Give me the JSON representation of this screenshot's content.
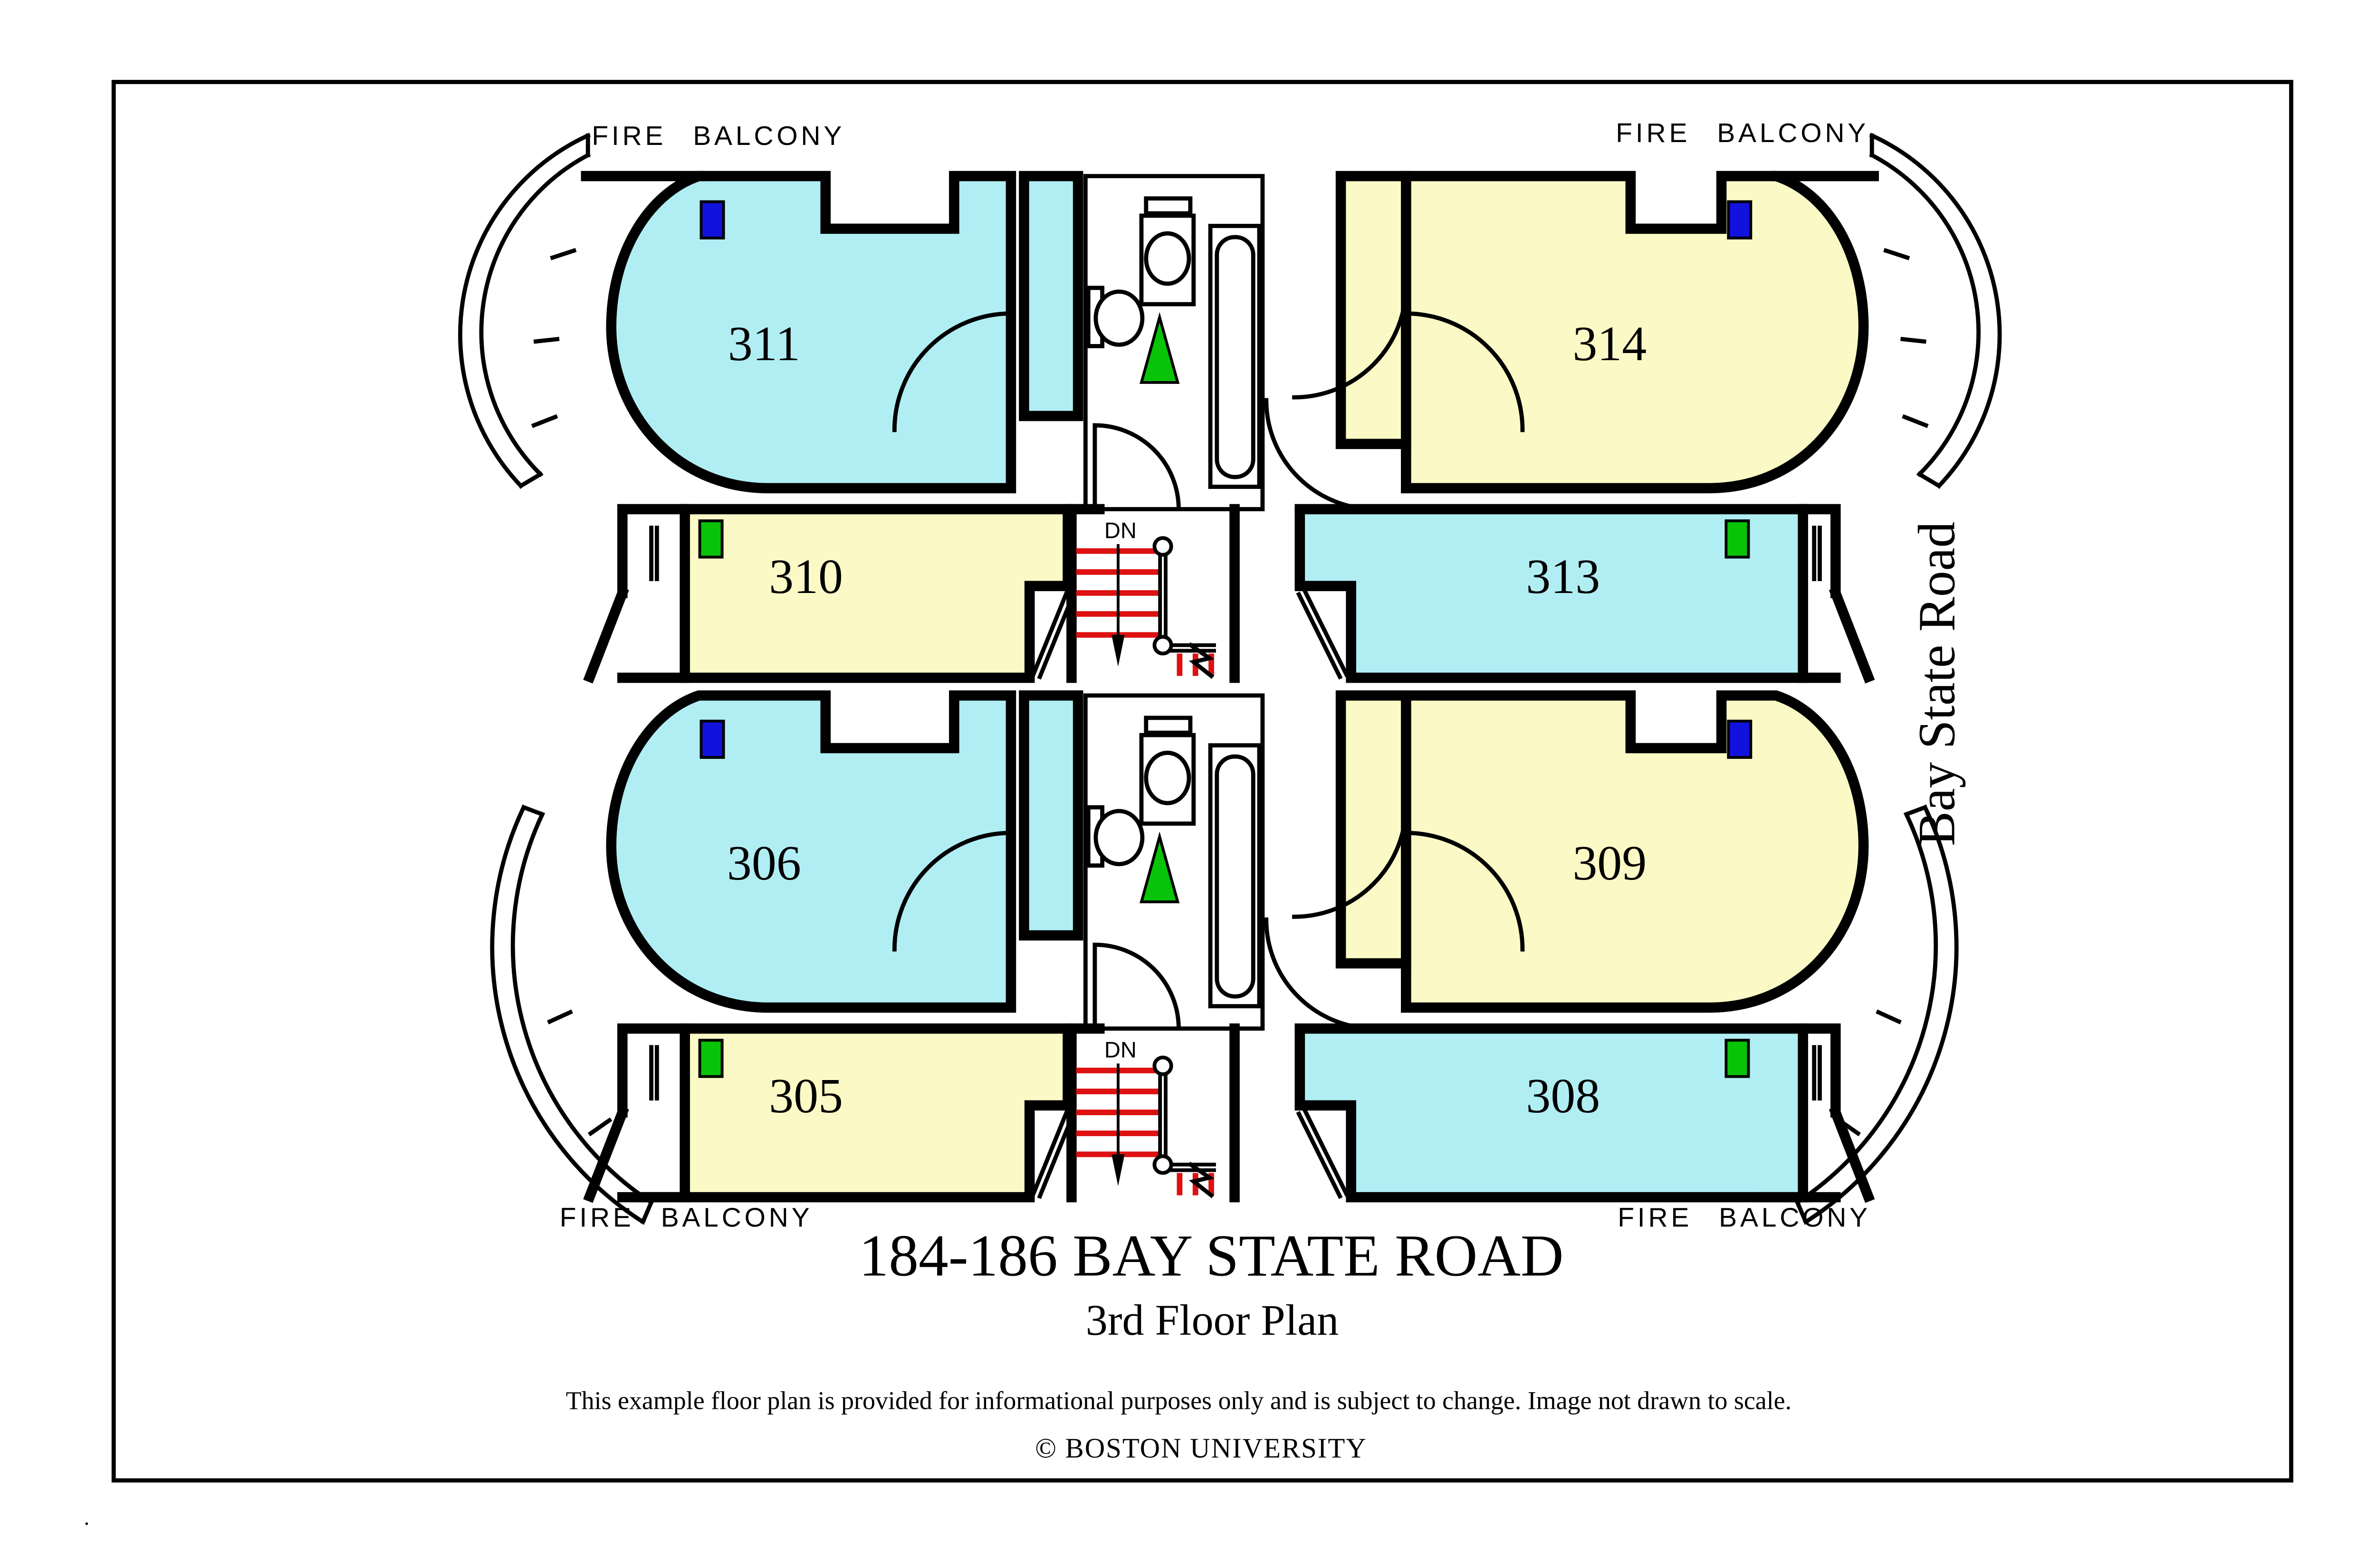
{
  "page": {
    "corner_mark": "."
  },
  "plan": {
    "fire_balcony_labels": {
      "top_left": "FIRE BALCONY",
      "top_right": "FIRE BALCONY",
      "bottom_left": "FIRE BALCONY",
      "bottom_right": "FIRE BALCONY"
    },
    "street_label": "Bay State Road",
    "stairs": {
      "direction_label": "DN"
    },
    "sections": {
      "upper": {
        "rooms": {
          "big_left": {
            "number": "311",
            "marker": "blue"
          },
          "strip_left": {
            "number": "310",
            "marker": "green"
          },
          "big_right": {
            "number": "314",
            "marker": "blue"
          },
          "strip_right": {
            "number": "313",
            "marker": "green"
          }
        }
      },
      "lower": {
        "rooms": {
          "big_left": {
            "number": "306",
            "marker": "blue"
          },
          "strip_left": {
            "number": "305",
            "marker": "green"
          },
          "big_right": {
            "number": "309",
            "marker": "blue"
          },
          "strip_right": {
            "number": "308",
            "marker": "green"
          }
        }
      }
    }
  },
  "title_block": {
    "title": "184-186 BAY STATE ROAD",
    "subtitle": "3rd Floor Plan",
    "disclaimer": "This example floor plan is provided for informational purposes only and is subject to change. Image not drawn to scale.",
    "copyright": "© BOSTON UNIVERSITY"
  },
  "colors": {
    "background": "#ffffff",
    "wall": "#000000",
    "room_cyan": "#b0eef4",
    "room_yellow": "#fbfac6",
    "marker_blue": "#1212dd",
    "marker_green": "#09c309",
    "stair_tread_red": "#dd1111"
  }
}
